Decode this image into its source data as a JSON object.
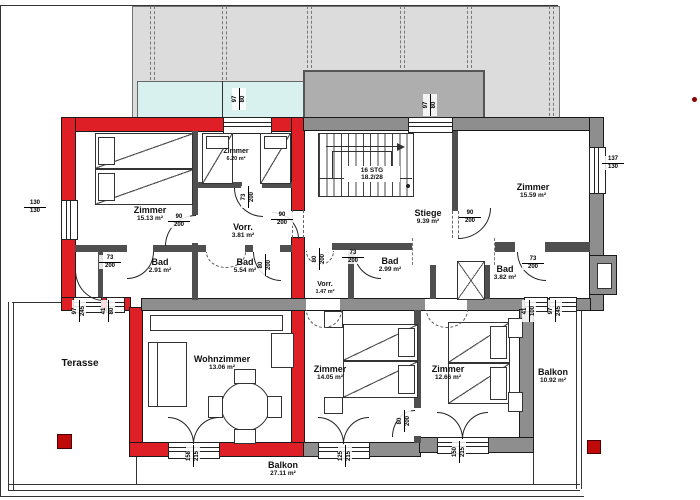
{
  "plan": {
    "colors": {
      "unit_highlight_red": "#df1f26",
      "wall_gray": "#8e8e8e",
      "roof_light": "#dcdcdc",
      "roof_dark": "#aeaeae",
      "skylight_cyan": "#d8f1ef"
    },
    "stairs": {
      "steps": "16 STG",
      "ratio": "18.2/28"
    },
    "rooms": [
      {
        "id": "zimmer-15",
        "name": "Zimmer",
        "area": "15.13 m²"
      },
      {
        "id": "zimmer-620",
        "name": "Zimmer",
        "area": "6.20 m²"
      },
      {
        "id": "vorr-381",
        "name": "Vorr.",
        "area": "3.81 m²"
      },
      {
        "id": "bad-291",
        "name": "Bad",
        "area": "2.91 m²"
      },
      {
        "id": "bad-554",
        "name": "Bad",
        "area": "5.54 m²"
      },
      {
        "id": "stiege",
        "name": "Stiege",
        "area": "9.39 m²"
      },
      {
        "id": "zimmer-1559",
        "name": "Zimmer",
        "area": "15.59 m²"
      },
      {
        "id": "vorr-147",
        "name": "Vorr.",
        "area": "1.47 m²"
      },
      {
        "id": "bad-299",
        "name": "Bad",
        "area": "2.99 m²"
      },
      {
        "id": "bad-382",
        "name": "Bad",
        "area": "3.82 m²"
      },
      {
        "id": "terasse",
        "name": "Terasse",
        "area": ""
      },
      {
        "id": "wohnzimmer",
        "name": "Wohnzimmer",
        "area": "13.06 m²"
      },
      {
        "id": "zimmer-1405",
        "name": "Zimmer",
        "area": "14.05 m²"
      },
      {
        "id": "zimmer-1266",
        "name": "Zimmer",
        "area": "12.66 m²"
      },
      {
        "id": "balkon-1092",
        "name": "Balkon",
        "area": "10.92 m²"
      },
      {
        "id": "balkon-2711",
        "name": "Balkon",
        "area": "27.11 m²"
      }
    ],
    "dimensions": [
      {
        "id": "win-left",
        "w": "130",
        "h": "130"
      },
      {
        "id": "win-right",
        "w": "137",
        "h": "130"
      },
      {
        "id": "door-zimmer15",
        "w": "90",
        "h": "200"
      },
      {
        "id": "door-vorr381",
        "w": "90",
        "h": "200"
      },
      {
        "id": "door-entry-right",
        "w": "90",
        "h": "200"
      },
      {
        "id": "door-bad291",
        "w": "73",
        "h": "200"
      },
      {
        "id": "door-bad299",
        "w": "73",
        "h": "200"
      },
      {
        "id": "door-bad382",
        "w": "73",
        "h": "200"
      },
      {
        "id": "door-zimmer620",
        "w": "73",
        "h": "200",
        "rot": true
      },
      {
        "id": "door-bad554",
        "w": "80",
        "h": "200",
        "rot": true
      },
      {
        "id": "door-vorr147",
        "w": "80",
        "h": "200",
        "rot": true
      },
      {
        "id": "door-bedrooms",
        "w": "80",
        "h": "200",
        "rot": true
      },
      {
        "id": "skylight-left",
        "w": "97",
        "h": "80",
        "rot": true
      },
      {
        "id": "skylight-right",
        "w": "97",
        "h": "80",
        "rot": true
      },
      {
        "id": "terr-win-a",
        "w": "97",
        "h": "245",
        "rot": true
      },
      {
        "id": "terr-win-b",
        "w": "41",
        "h": "80",
        "rot": true
      },
      {
        "id": "balk-win-a",
        "w": "41",
        "h": "100",
        "rot": true
      },
      {
        "id": "balk-win-b",
        "w": "97",
        "h": "245",
        "rot": true
      },
      {
        "id": "door-wohnzimmer",
        "w": "158",
        "h": "215",
        "rot": true
      },
      {
        "id": "door-zimmer1405",
        "w": "125",
        "h": "215",
        "rot": true
      },
      {
        "id": "door-zimmer1266",
        "w": "150",
        "h": "215",
        "rot": true
      }
    ]
  }
}
